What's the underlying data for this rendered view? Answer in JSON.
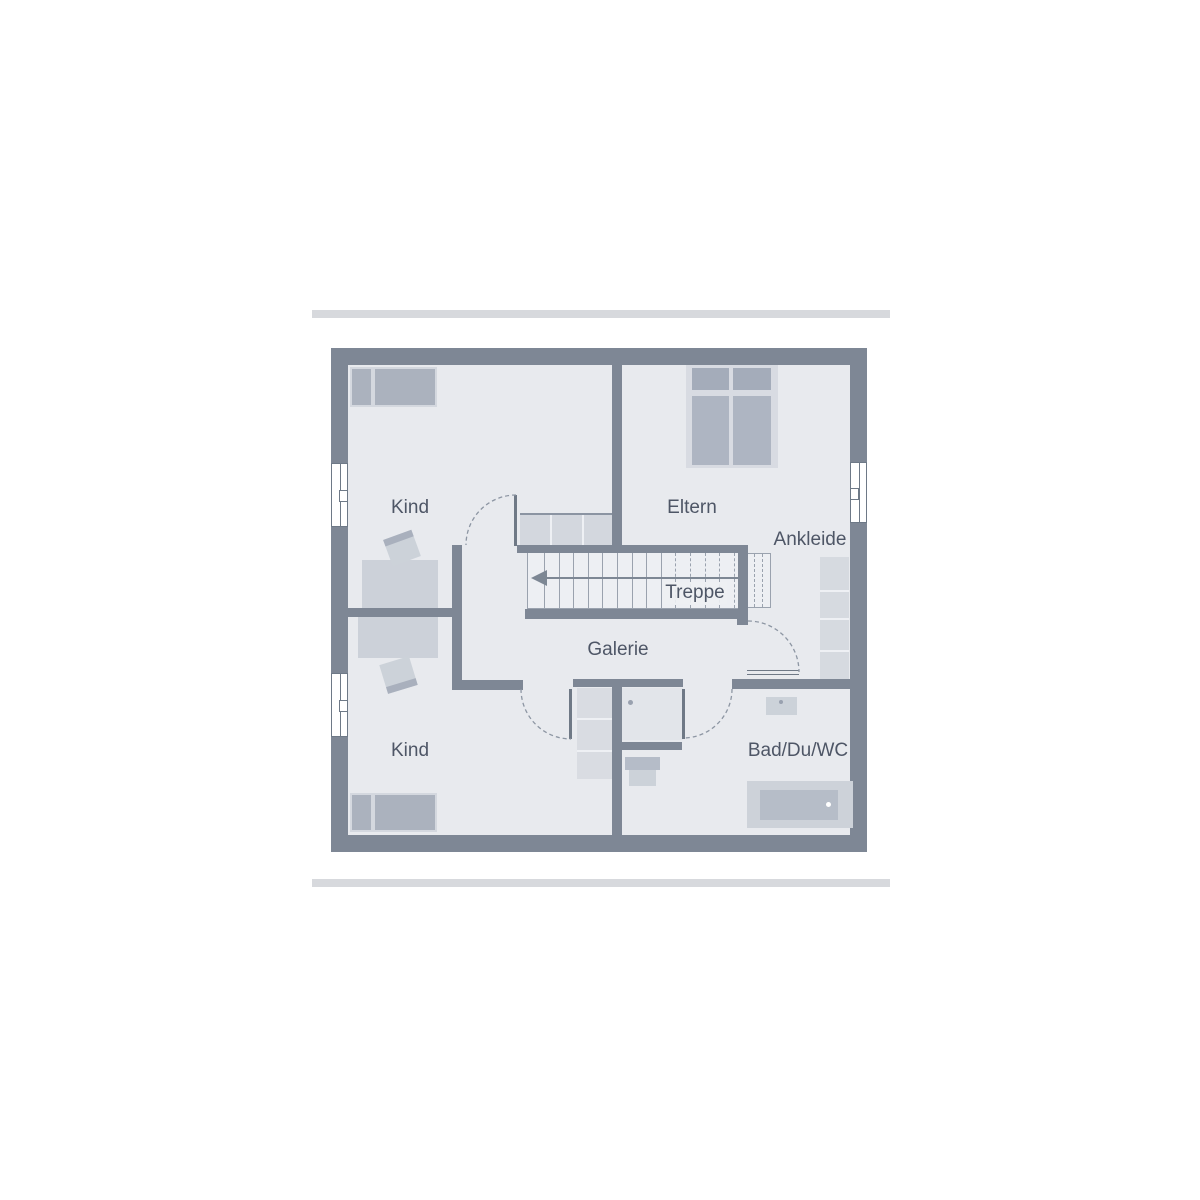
{
  "plan": {
    "type": "floor-plan",
    "language": "de",
    "rooms": [
      {
        "id": "kind-top",
        "label": "Kind"
      },
      {
        "id": "eltern",
        "label": "Eltern"
      },
      {
        "id": "ankleide",
        "label": "Ankleide"
      },
      {
        "id": "treppe",
        "label": "Treppe"
      },
      {
        "id": "galerie",
        "label": "Galerie"
      },
      {
        "id": "kind-bottom",
        "label": "Kind"
      },
      {
        "id": "bad-du-wc",
        "label": "Bad/Du/WC"
      }
    ]
  },
  "stairs": {
    "solid_treads": 9,
    "dashed_treads": 5,
    "extension_treads": 2,
    "tread_start": 16,
    "tread_step": 14.6,
    "direction": "down-left"
  },
  "colors": {
    "wall": "#7e8795",
    "floor": "#e8eaee",
    "furniture_light": "#d4d8df",
    "furniture_medium": "#b6bdc9",
    "stair_fill": "#edeff3",
    "line": "#8d96a3",
    "divider_bar": "#d7d9dd",
    "label_text": "#4e5666",
    "background": "#ffffff"
  }
}
